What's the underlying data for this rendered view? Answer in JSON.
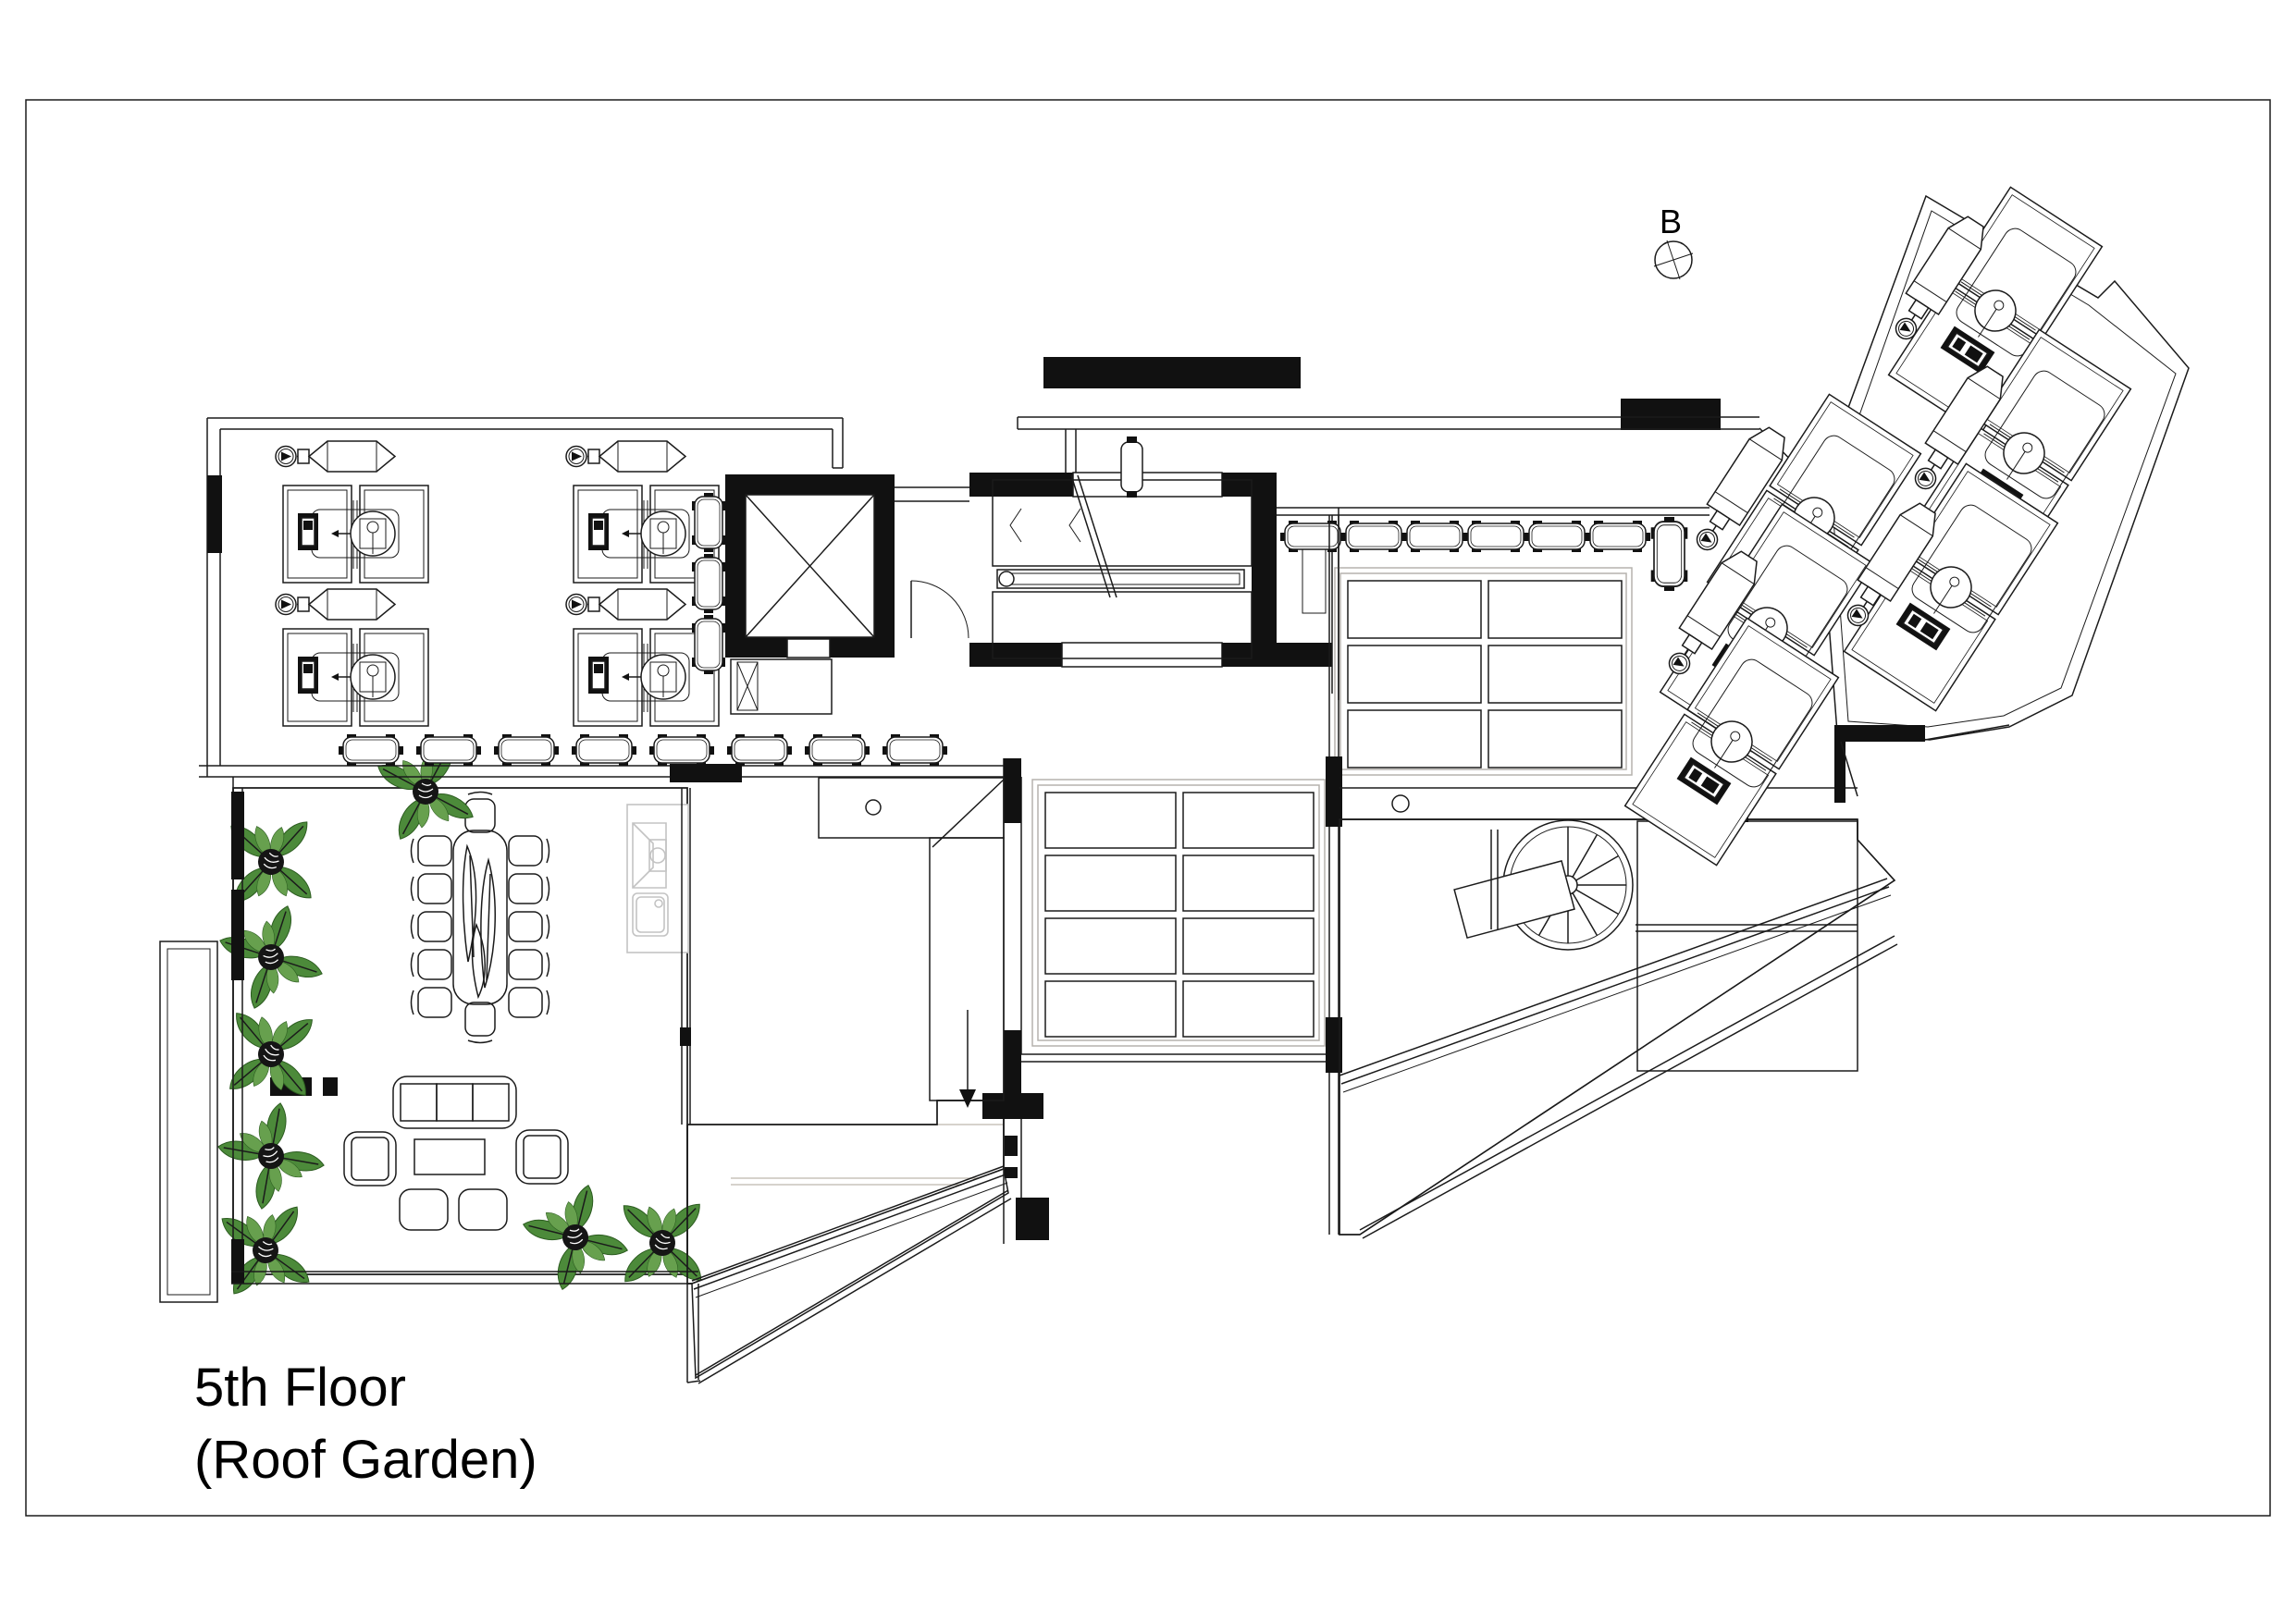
{
  "title": {
    "line1": "5th Floor",
    "line2": "(Roof Garden)"
  },
  "marker": {
    "label": "B"
  },
  "colors": {
    "frame_gray": "#dcdcdc",
    "line_black": "#1b1b1b",
    "tile_tan": "#c19b72",
    "plant_green": "#4c8a3a",
    "wood_brown": "#6b4a2e",
    "louver_gray": "#d9d9d9"
  }
}
